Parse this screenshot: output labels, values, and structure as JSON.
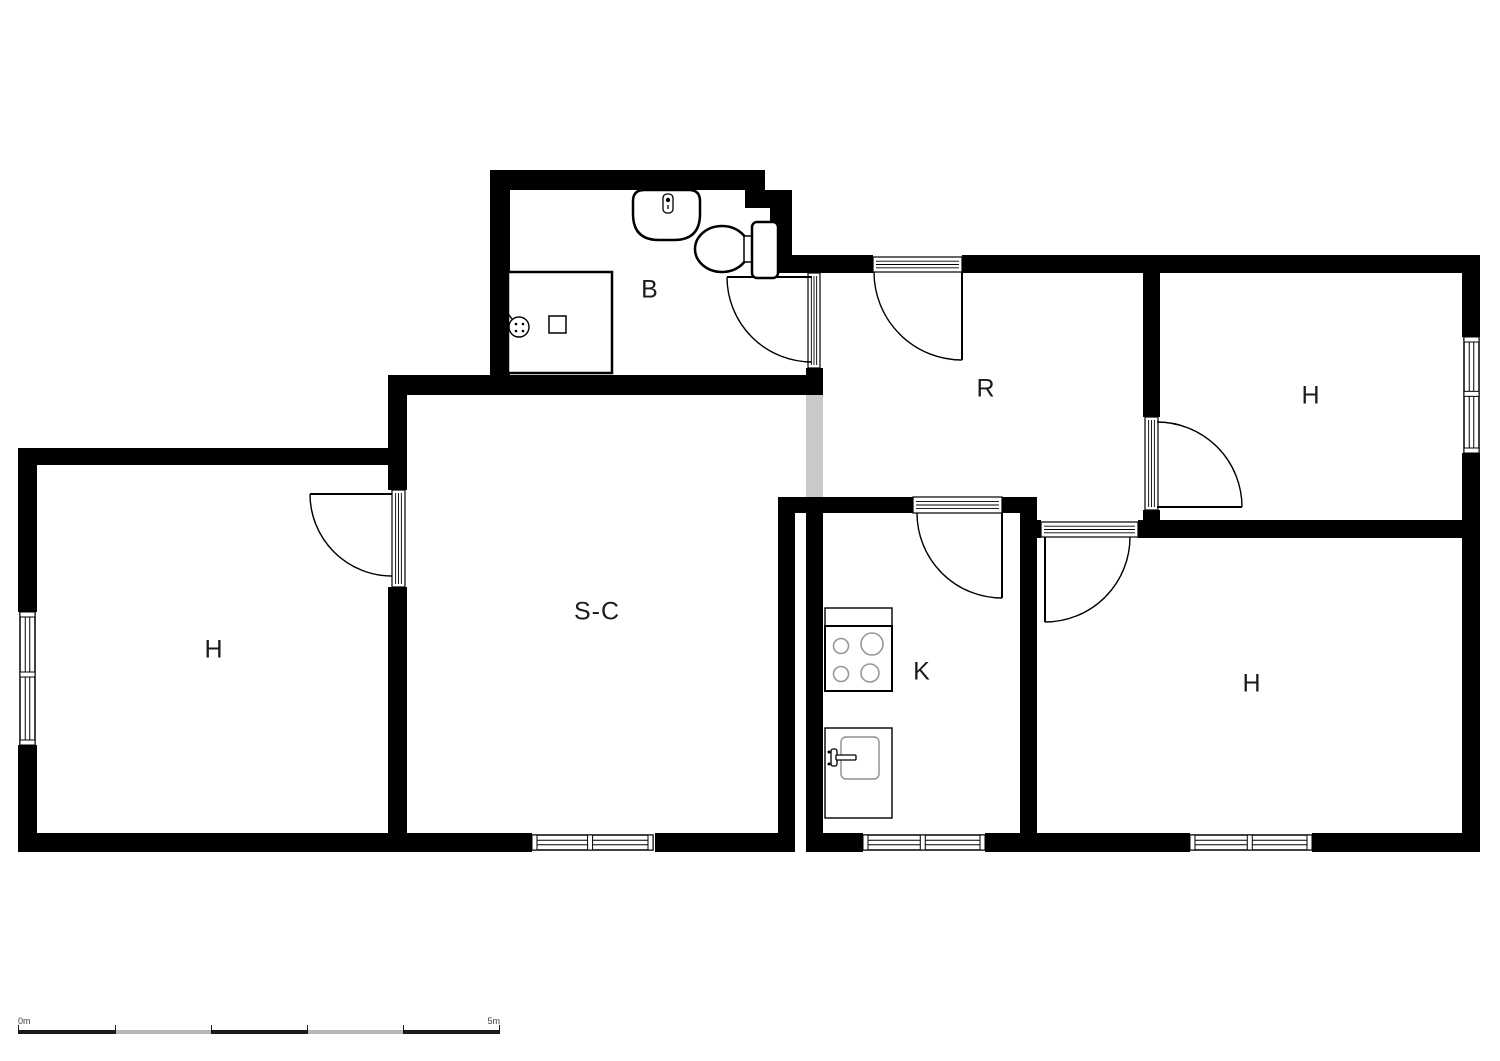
{
  "colors": {
    "wall": "#000000",
    "line": "#000000",
    "passage": "#c9c9c9",
    "fixture_gray": "#979797",
    "background": "#ffffff",
    "label": "#1b1b1b",
    "scale_dark": "#1a1a1a",
    "scale_gray": "#b7b7b7"
  },
  "plan": {
    "width": 1500,
    "height": 1061,
    "rooms": [
      {
        "id": "bathroom",
        "label": "B",
        "x": 650,
        "y": 290
      },
      {
        "id": "hall",
        "label": "R",
        "x": 986,
        "y": 389
      },
      {
        "id": "bedroom-top-right",
        "label": "H",
        "x": 1311,
        "y": 396
      },
      {
        "id": "living-room",
        "label": "S-C",
        "x": 597,
        "y": 612
      },
      {
        "id": "bedroom-left",
        "label": "H",
        "x": 214,
        "y": 650
      },
      {
        "id": "kitchen",
        "label": "K",
        "x": 922,
        "y": 672
      },
      {
        "id": "bedroom-bottom-right",
        "label": "H",
        "x": 1252,
        "y": 684
      }
    ],
    "walls": [
      [
        490,
        170,
        275,
        20
      ],
      [
        490,
        190,
        20,
        205
      ],
      [
        745,
        190,
        47,
        18
      ],
      [
        770,
        208,
        22,
        52
      ],
      [
        770,
        255,
        103,
        18
      ],
      [
        962,
        255,
        518,
        18
      ],
      [
        1462,
        273,
        18,
        64
      ],
      [
        1462,
        453,
        18,
        399
      ],
      [
        806,
        368,
        17,
        27
      ],
      [
        388,
        375,
        435,
        20
      ],
      [
        388,
        395,
        19,
        95
      ],
      [
        388,
        587,
        19,
        246
      ],
      [
        18,
        448,
        372,
        17
      ],
      [
        18,
        465,
        19,
        147
      ],
      [
        18,
        745,
        19,
        88
      ],
      [
        18,
        833,
        514,
        19
      ],
      [
        655,
        833,
        140,
        19
      ],
      [
        778,
        497,
        17,
        355
      ],
      [
        806,
        497,
        17,
        355
      ],
      [
        778,
        497,
        135,
        16
      ],
      [
        1002,
        497,
        35,
        16
      ],
      [
        1020,
        513,
        17,
        339
      ],
      [
        806,
        833,
        57,
        19
      ],
      [
        985,
        833,
        52,
        19
      ],
      [
        1037,
        520,
        4,
        18
      ],
      [
        1138,
        520,
        324,
        18
      ],
      [
        1143,
        255,
        17,
        162
      ],
      [
        1143,
        510,
        17,
        28
      ],
      [
        1037,
        833,
        153,
        19
      ],
      [
        1312,
        833,
        168,
        19
      ]
    ],
    "passages": [
      [
        806,
        395,
        17,
        102
      ]
    ],
    "windows": [
      {
        "x": 20,
        "y": 612,
        "w": 15,
        "h": 133,
        "d": 0.47
      },
      {
        "x": 1464,
        "y": 337,
        "w": 15,
        "h": 116,
        "d": 0.49
      },
      {
        "x": 532,
        "y": 835,
        "w": 121,
        "h": 15,
        "d": 0.48
      },
      {
        "x": 863,
        "y": 835,
        "w": 122,
        "h": 15,
        "d": 0.49
      },
      {
        "x": 1190,
        "y": 835,
        "w": 122,
        "h": 15,
        "d": 0.49
      }
    ],
    "doors": [
      {
        "id": "bathroom-door",
        "frame": [
          808,
          273,
          12,
          95
        ],
        "leaf": [
          727,
          277,
          812,
          277
        ],
        "arc": "M 727 277 A 85 85 0 0 0 812 362"
      },
      {
        "id": "entrance-door",
        "frame": [
          873,
          257,
          89,
          15
        ],
        "leaf": [
          962,
          272,
          962,
          360
        ],
        "arc": "M 874 272 A 88 88 0 0 0 962 360"
      },
      {
        "id": "living-bedroom-door",
        "frame": [
          392,
          490,
          13,
          97
        ],
        "leaf": [
          310,
          494,
          392,
          494
        ],
        "arc": "M 310 494 A 82 82 0 0 0 392 576"
      },
      {
        "id": "kitchen-door",
        "frame": [
          913,
          497,
          89,
          16
        ],
        "leaf": [
          1002,
          513,
          1002,
          598
        ],
        "arc": "M 917 513 A 85 85 0 0 0 1002 598"
      },
      {
        "id": "bedroom-br-door",
        "frame": [
          1041,
          522,
          97,
          15
        ],
        "leaf": [
          1045,
          537,
          1045,
          622
        ],
        "arc": "M 1130 537 A 85 85 0 0 1 1045 622"
      },
      {
        "id": "bedroom-tr-door",
        "frame": [
          1145,
          417,
          13,
          93
        ],
        "leaf": [
          1157,
          507,
          1242,
          507
        ],
        "arc": "M 1157 422 A 85 85 0 0 1 1242 507"
      }
    ],
    "fixtures": [
      {
        "name": "toilet",
        "shapes": [
          {
            "t": "ellipse",
            "cx": 722,
            "cy": 249,
            "rx": 27,
            "ry": 23,
            "sw": 2.5
          },
          {
            "t": "rect",
            "x": 744,
            "y": 236,
            "w": 14,
            "h": 26,
            "sw": 1.5
          },
          {
            "t": "rect",
            "x": 752,
            "y": 222,
            "w": 26,
            "h": 56,
            "rx": 5,
            "sw": 2.5
          }
        ]
      },
      {
        "name": "bathroom-sink",
        "shapes": [
          {
            "t": "path",
            "d": "M 633 201 Q 633 190 644 190 L 689 190 Q 700 190 700 201 L 700 214 Q 700 240 674 240 L 659 240 Q 633 240 633 214 Z",
            "sw": 2.5
          },
          {
            "t": "rect",
            "x": 663,
            "y": 194,
            "w": 10,
            "h": 19,
            "rx": 4,
            "sw": 1.3
          },
          {
            "t": "circle",
            "cx": 668,
            "cy": 200,
            "r": 2.2,
            "fill": "#000000",
            "sw": 0
          },
          {
            "t": "line",
            "x1": 668,
            "y1": 205,
            "x2": 668,
            "y2": 209,
            "sw": 1.3
          }
        ]
      },
      {
        "name": "shower",
        "shapes": [
          {
            "t": "rect",
            "x": 508,
            "y": 272,
            "w": 104,
            "h": 101,
            "sw": 2.5
          },
          {
            "t": "rect",
            "x": 549,
            "y": 316,
            "w": 17,
            "h": 17,
            "sw": 1.5
          },
          {
            "t": "circle",
            "cx": 519,
            "cy": 327,
            "r": 10,
            "sw": 1.4
          },
          {
            "t": "line",
            "x1": 512,
            "y1": 319,
            "x2": 506,
            "y2": 311,
            "sw": 1.4
          },
          {
            "t": "circle",
            "cx": 516,
            "cy": 324,
            "r": 1.3,
            "fill": "#000000",
            "sw": 0
          },
          {
            "t": "circle",
            "cx": 523,
            "cy": 324,
            "r": 1.3,
            "fill": "#000000",
            "sw": 0
          },
          {
            "t": "circle",
            "cx": 516,
            "cy": 331,
            "r": 1.3,
            "fill": "#000000",
            "sw": 0
          },
          {
            "t": "circle",
            "cx": 523,
            "cy": 331,
            "r": 1.3,
            "fill": "#000000",
            "sw": 0
          }
        ]
      },
      {
        "name": "kitchen-counter",
        "shapes": [
          {
            "t": "rect",
            "x": 825,
            "y": 608,
            "w": 67,
            "h": 18,
            "sw": 1.4
          },
          {
            "t": "rect",
            "x": 825,
            "y": 728,
            "w": 67,
            "h": 90,
            "sw": 1.4
          }
        ]
      },
      {
        "name": "stove",
        "shapes": [
          {
            "t": "rect",
            "x": 825,
            "y": 626,
            "w": 67,
            "h": 65,
            "sw": 2
          },
          {
            "t": "circle",
            "cx": 841,
            "cy": 646,
            "r": 7.5,
            "sw": 1.6,
            "stroke": "#979797",
            "fill": "none"
          },
          {
            "t": "circle",
            "cx": 872,
            "cy": 644,
            "r": 11,
            "sw": 1.6,
            "stroke": "#979797",
            "fill": "none"
          },
          {
            "t": "circle",
            "cx": 841,
            "cy": 674,
            "r": 7.5,
            "sw": 1.6,
            "stroke": "#979797",
            "fill": "none"
          },
          {
            "t": "circle",
            "cx": 870,
            "cy": 673,
            "r": 9,
            "sw": 1.6,
            "stroke": "#979797",
            "fill": "none"
          }
        ]
      },
      {
        "name": "kitchen-sink",
        "shapes": [
          {
            "t": "rect",
            "x": 841,
            "y": 737,
            "w": 38,
            "h": 42,
            "rx": 5,
            "sw": 1.4,
            "stroke": "#8d8d8d"
          },
          {
            "t": "rect",
            "x": 831,
            "y": 749,
            "w": 6,
            "h": 17,
            "rx": 2,
            "sw": 1.3
          },
          {
            "t": "rect",
            "x": 836,
            "y": 755,
            "w": 20,
            "h": 5,
            "rx": 1,
            "sw": 1.3
          },
          {
            "t": "circle",
            "cx": 829,
            "cy": 752,
            "r": 1.5,
            "fill": "#000000",
            "sw": 0
          },
          {
            "t": "circle",
            "cx": 829,
            "cy": 764,
            "r": 1.5,
            "fill": "#000000",
            "sw": 0
          }
        ]
      }
    ]
  },
  "scale_bar": {
    "start_label": "0m",
    "end_label": "5m",
    "segments": [
      {
        "w": 97,
        "tone": "dark"
      },
      {
        "w": 96,
        "tone": "gray"
      },
      {
        "w": 96,
        "tone": "dark"
      },
      {
        "w": 96,
        "tone": "gray"
      },
      {
        "w": 97,
        "tone": "dark"
      }
    ]
  }
}
